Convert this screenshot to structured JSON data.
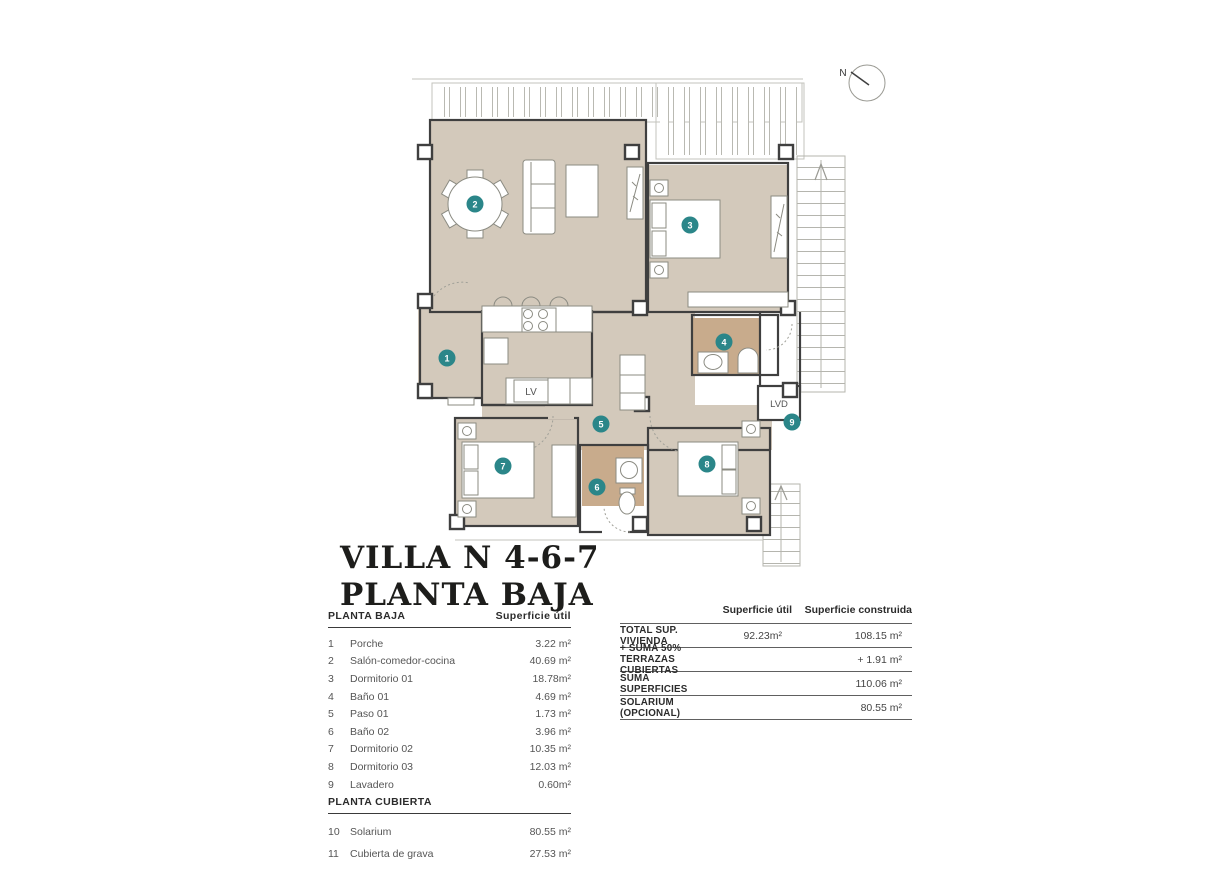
{
  "title": {
    "line1": "VILLA N 4-6-7",
    "line2": "PLANTA BAJA"
  },
  "compass": {
    "label": "N"
  },
  "plan": {
    "labels": {
      "lv": "LV",
      "lvd": "LVD"
    },
    "markers": [
      {
        "n": "1",
        "room": "Porche"
      },
      {
        "n": "2",
        "room": "Salón-comedor-cocina"
      },
      {
        "n": "3",
        "room": "Dormitorio 01"
      },
      {
        "n": "4",
        "room": "Baño 01"
      },
      {
        "n": "5",
        "room": "Paso 01"
      },
      {
        "n": "6",
        "room": "Baño 02"
      },
      {
        "n": "7",
        "room": "Dormitorio 02"
      },
      {
        "n": "8",
        "room": "Dormitorio 03"
      },
      {
        "n": "9",
        "room": "Lavadero"
      }
    ],
    "colors": {
      "floor": "#d3c9bb",
      "bathroom_floor": "#c8ab8c",
      "marker": "#2b8689",
      "wall": "#3f3f3f"
    }
  },
  "left_table": {
    "sections": [
      {
        "header": "PLANTA BAJA",
        "col_header": "Superficie útil",
        "rows": [
          {
            "num": "1",
            "label": "Porche",
            "value": "3.22 m²"
          },
          {
            "num": "2",
            "label": "Salón-comedor-cocina",
            "value": "40.69 m²"
          },
          {
            "num": "3",
            "label": "Dormitorio 01",
            "value": "18.78m²"
          },
          {
            "num": "4",
            "label": "Baño 01",
            "value": "4.69 m²"
          },
          {
            "num": "5",
            "label": "Paso 01",
            "value": "1.73 m²"
          },
          {
            "num": "6",
            "label": "Baño 02",
            "value": "3.96 m²"
          },
          {
            "num": "7",
            "label": "Dormitorio 02",
            "value": "10.35 m²"
          },
          {
            "num": "8",
            "label": "Dormitorio 03",
            "value": "12.03 m²"
          },
          {
            "num": "9",
            "label": "Lavadero",
            "value": "0.60m²"
          }
        ]
      },
      {
        "header": "PLANTA CUBIERTA",
        "rows": [
          {
            "num": "10",
            "label": "Solarium",
            "value": "80.55 m²"
          },
          {
            "num": "11",
            "label": "Cubierta de grava",
            "value": "27.53 m²"
          }
        ]
      }
    ]
  },
  "summary_table": {
    "col_util": "Superficie útil",
    "col_construida": "Superficie construida",
    "rows": [
      {
        "label": "TOTAL SUP. VIVIENDA",
        "util": "92.23m²",
        "construida": "108.15 m²"
      },
      {
        "label": "+ SUMA 50% TERRAZAS CUBIERTAS",
        "util": "",
        "construida": "+ 1.91 m²"
      },
      {
        "label": "SUMA SUPERFICIES",
        "util": "",
        "construida": "110.06 m²"
      },
      {
        "label": "SOLARIUM (OPCIONAL)",
        "util": "",
        "construida": "80.55 m²"
      }
    ]
  }
}
